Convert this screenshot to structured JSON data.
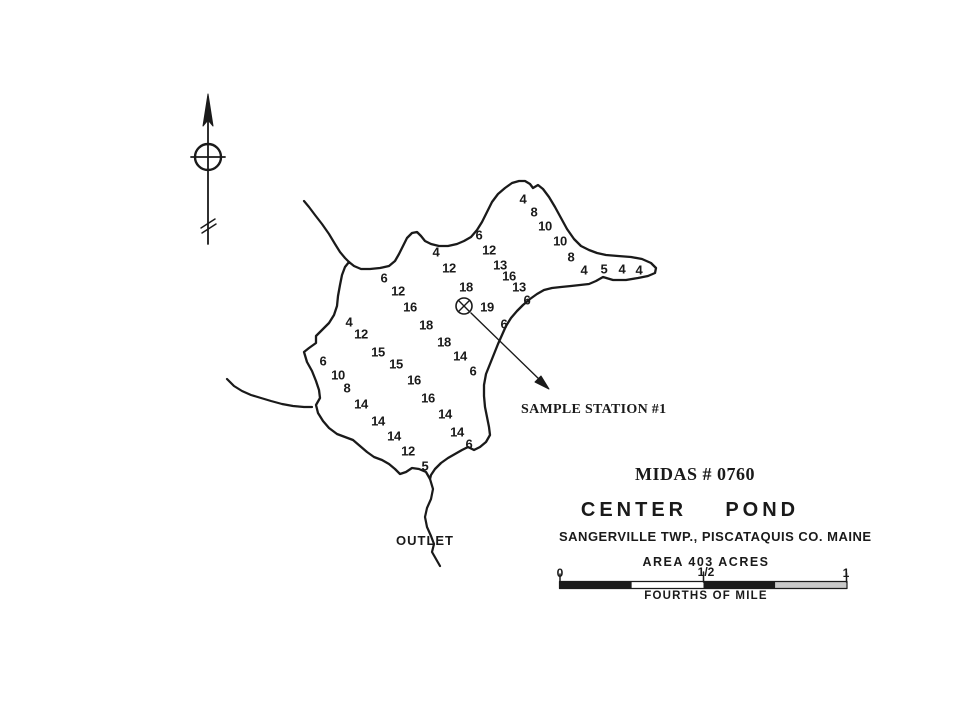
{
  "colors": {
    "ink": "#1a1a1a",
    "paper": "#ffffff",
    "scale_light_segment": "#c9c9c9"
  },
  "title_block": {
    "midas": "MIDAS # 0760",
    "pond_name": "CENTER    POND",
    "location": "SANGERVILLE TWP., PISCATAQUIS CO. MAINE",
    "area": "AREA 403 ACRES",
    "scale_caption": "FOURTHS OF MILE",
    "scale_ticks": [
      "0",
      "1/2",
      "1"
    ]
  },
  "map": {
    "outlet_label": "OUTLET",
    "sample_station_label": "SAMPLE STATION #1",
    "north_arrow_icon": "north-arrow-compass",
    "sample_station_icon": "circled-x-marker",
    "depth_soundings": [
      {
        "v": "4",
        "x": 523,
        "y": 199
      },
      {
        "v": "8",
        "x": 534,
        "y": 212
      },
      {
        "v": "10",
        "x": 545,
        "y": 226
      },
      {
        "v": "10",
        "x": 560,
        "y": 241
      },
      {
        "v": "8",
        "x": 571,
        "y": 257
      },
      {
        "v": "4",
        "x": 584,
        "y": 270
      },
      {
        "v": "5",
        "x": 604,
        "y": 269
      },
      {
        "v": "4",
        "x": 622,
        "y": 269
      },
      {
        "v": "4",
        "x": 639,
        "y": 270
      },
      {
        "v": "6",
        "x": 479,
        "y": 235
      },
      {
        "v": "4",
        "x": 436,
        "y": 252
      },
      {
        "v": "12",
        "x": 489,
        "y": 250
      },
      {
        "v": "12",
        "x": 449,
        "y": 268
      },
      {
        "v": "13",
        "x": 500,
        "y": 265
      },
      {
        "v": "16",
        "x": 509,
        "y": 276
      },
      {
        "v": "13",
        "x": 519,
        "y": 287
      },
      {
        "v": "6",
        "x": 527,
        "y": 300
      },
      {
        "v": "18",
        "x": 466,
        "y": 287
      },
      {
        "v": "19",
        "x": 487,
        "y": 307
      },
      {
        "v": "6",
        "x": 384,
        "y": 278
      },
      {
        "v": "12",
        "x": 398,
        "y": 291
      },
      {
        "v": "16",
        "x": 410,
        "y": 307
      },
      {
        "v": "4",
        "x": 349,
        "y": 322
      },
      {
        "v": "12",
        "x": 361,
        "y": 334
      },
      {
        "v": "15",
        "x": 378,
        "y": 352
      },
      {
        "v": "15",
        "x": 396,
        "y": 364
      },
      {
        "v": "18",
        "x": 426,
        "y": 325
      },
      {
        "v": "18",
        "x": 444,
        "y": 342
      },
      {
        "v": "14",
        "x": 460,
        "y": 356
      },
      {
        "v": "6",
        "x": 504,
        "y": 324
      },
      {
        "v": "6",
        "x": 473,
        "y": 371
      },
      {
        "v": "6",
        "x": 323,
        "y": 361
      },
      {
        "v": "10",
        "x": 338,
        "y": 375
      },
      {
        "v": "8",
        "x": 347,
        "y": 388
      },
      {
        "v": "16",
        "x": 414,
        "y": 380
      },
      {
        "v": "16",
        "x": 428,
        "y": 398
      },
      {
        "v": "14",
        "x": 361,
        "y": 404
      },
      {
        "v": "14",
        "x": 378,
        "y": 421
      },
      {
        "v": "14",
        "x": 394,
        "y": 436
      },
      {
        "v": "14",
        "x": 445,
        "y": 414
      },
      {
        "v": "14",
        "x": 457,
        "y": 432
      },
      {
        "v": "6",
        "x": 469,
        "y": 444
      },
      {
        "v": "12",
        "x": 408,
        "y": 451
      },
      {
        "v": "5",
        "x": 425,
        "y": 466
      }
    ]
  }
}
